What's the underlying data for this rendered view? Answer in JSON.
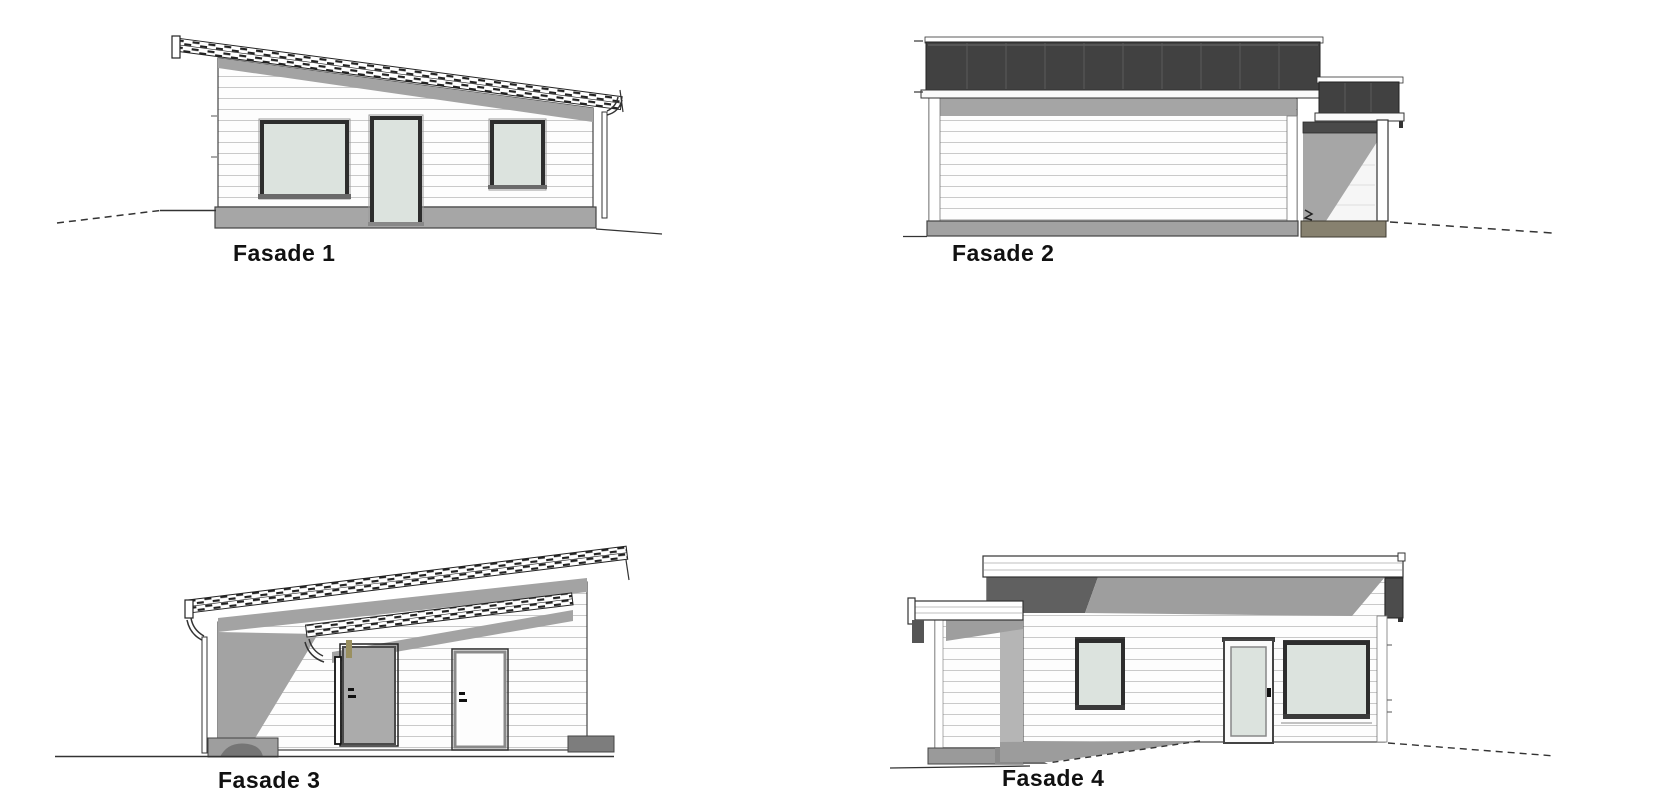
{
  "sheet": {
    "type": "architectural-elevation-drawing",
    "background": "#ffffff"
  },
  "facades": [
    {
      "label": "Fasade 1"
    },
    {
      "label": "Fasade 2"
    },
    {
      "label": "Fasade 3"
    },
    {
      "label": "Fasade 4"
    }
  ],
  "colors": {
    "line": "#333333",
    "roof_dark": "#414141",
    "roof_seam": "#5c5c5c",
    "eave_shadow": "#a3a3a3",
    "glass": "#dce3de",
    "siding_line": "#c9c9c9",
    "foundation_gray": "#a2a2a2",
    "foundation_khaki": "#87816f",
    "door_gray": "#ababab",
    "label_text": "#111111"
  }
}
